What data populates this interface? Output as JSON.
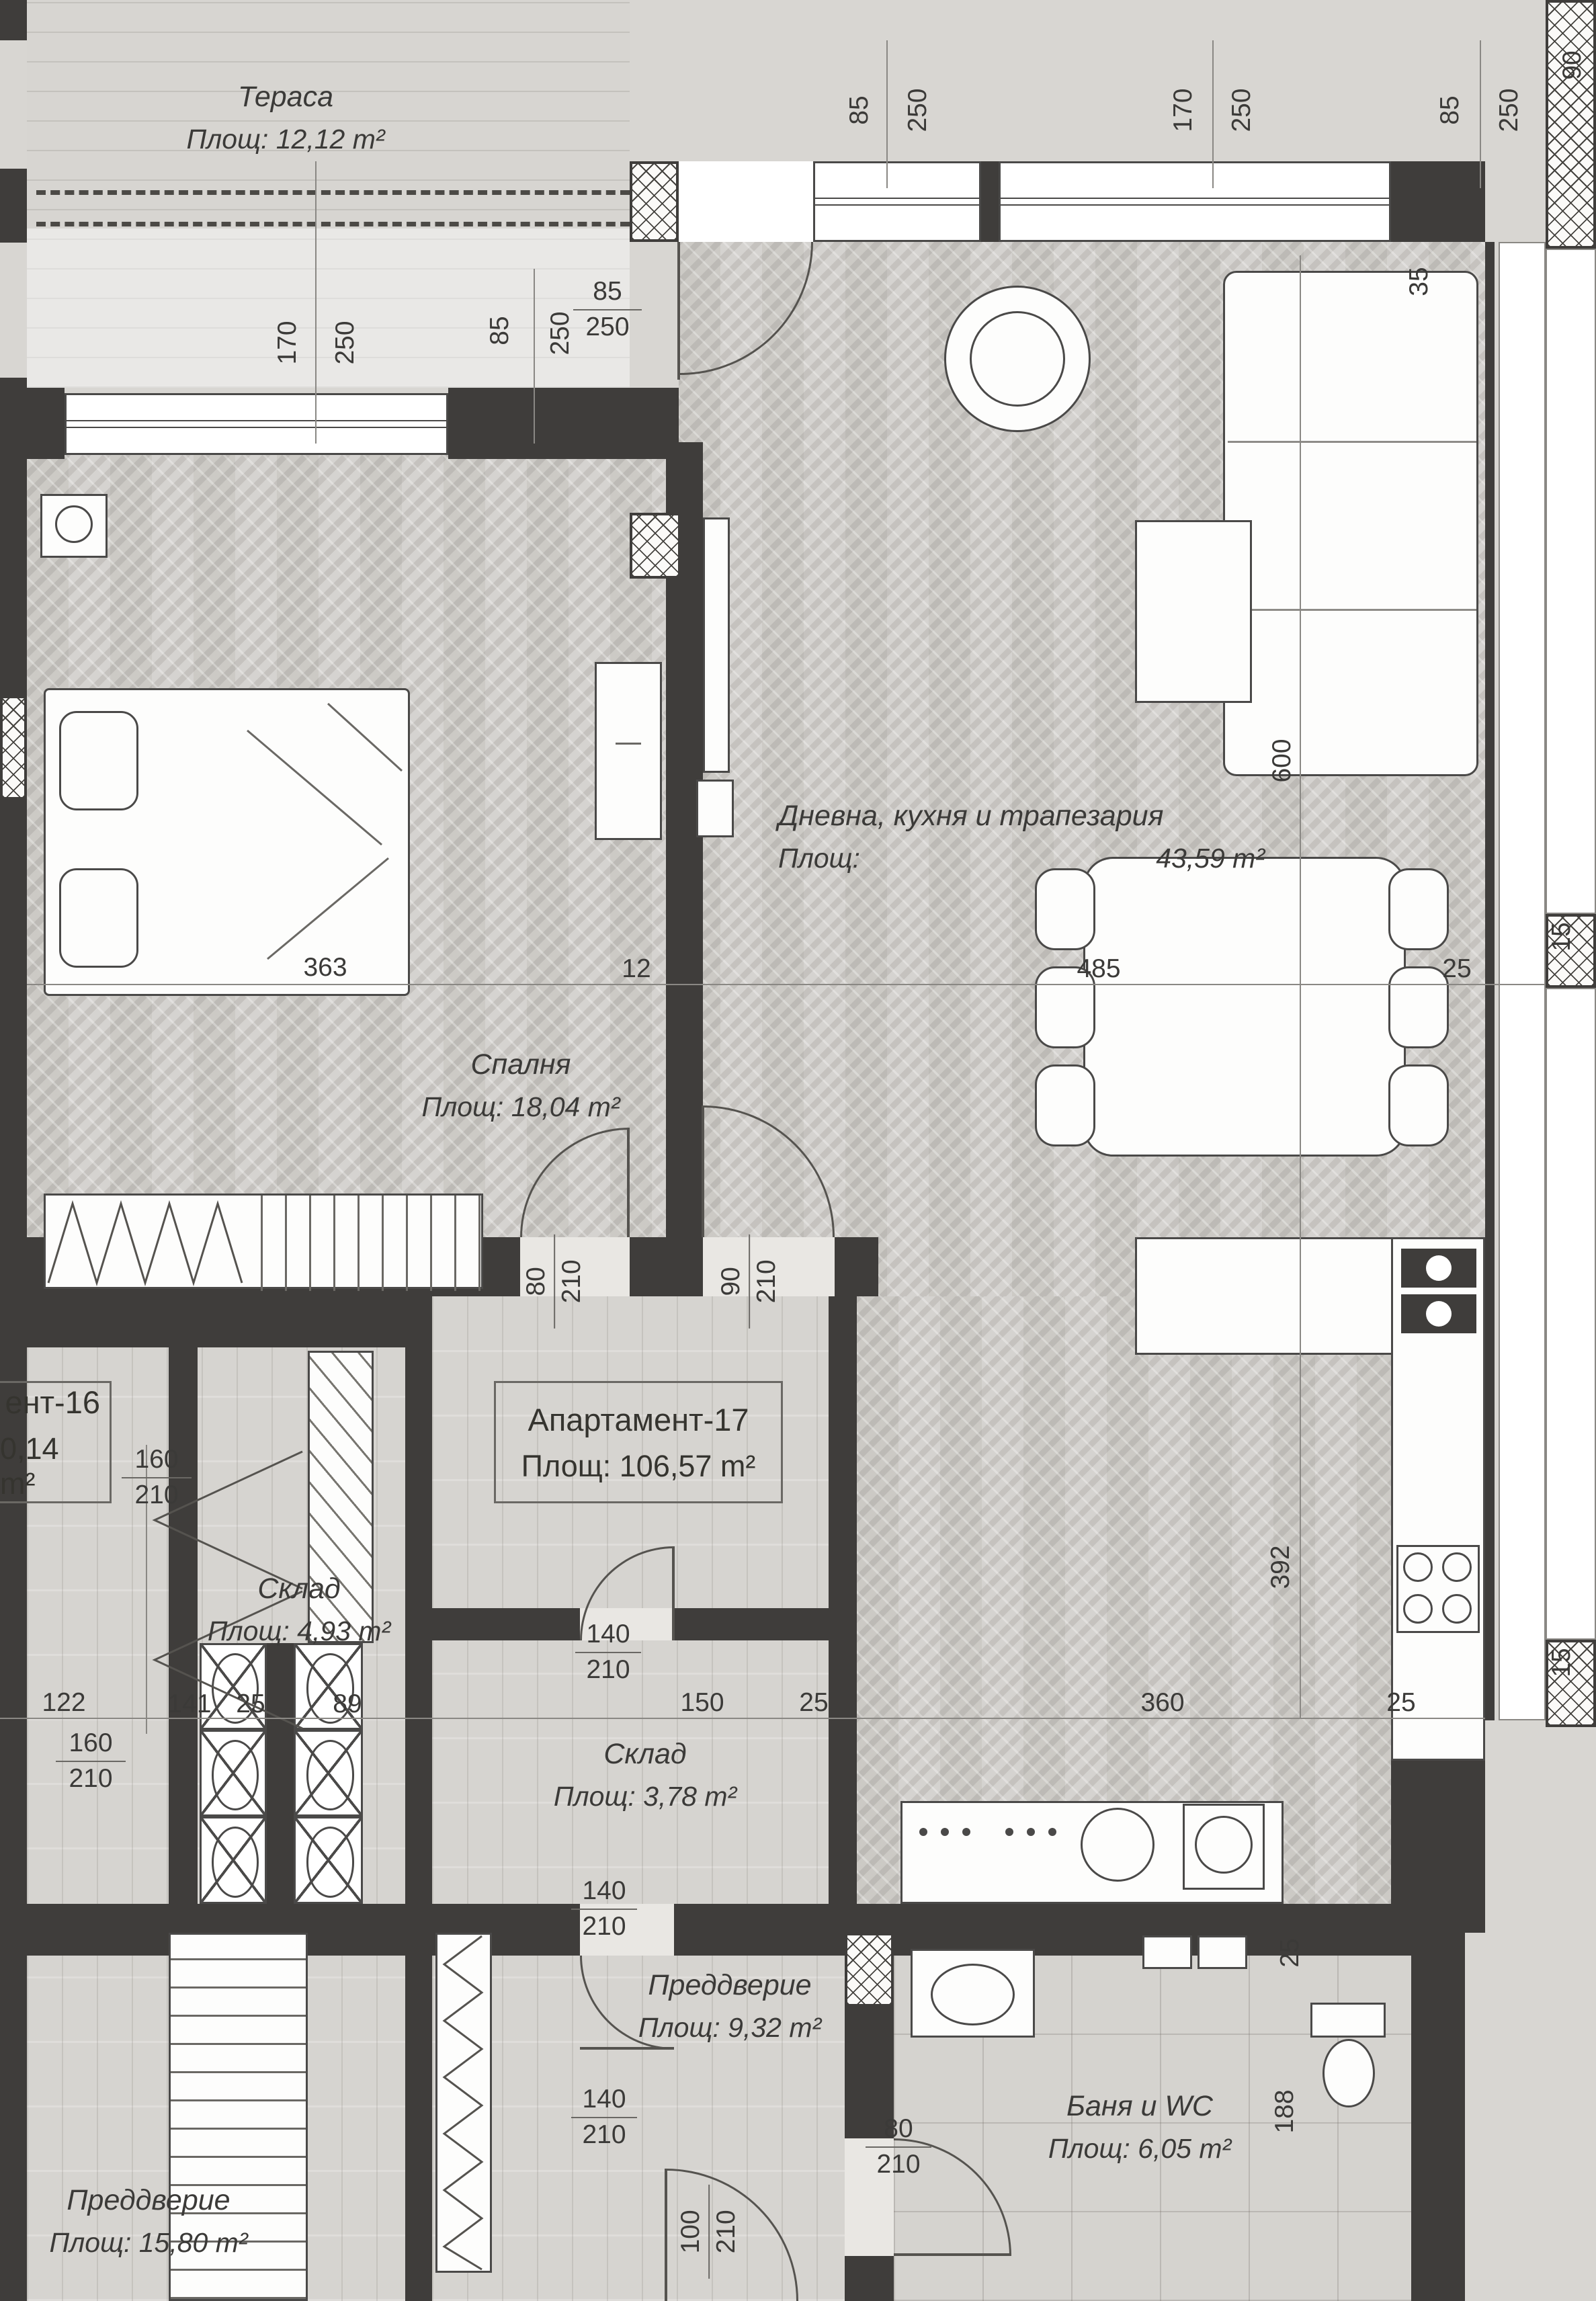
{
  "rooms": {
    "terrace": {
      "name": "Тераса",
      "area": "Площ: 12,12 m²"
    },
    "bedroom": {
      "name": "Спалня",
      "area": "Площ: 18,04 m²"
    },
    "living": {
      "name": "Дневна, кухня и трапезария",
      "area_label": "Площ:",
      "area_value": "43,59 m²"
    },
    "apartment17": {
      "name": "Апартамент-17",
      "area": "Площ: 106,57 m²"
    },
    "apartment16": {
      "name": "ент-16",
      "area": "0,14 m²"
    },
    "storage1": {
      "name": "Склад",
      "area": "Площ: 4,93 m²"
    },
    "storage2": {
      "name": "Склад",
      "area": "Площ: 3,78 m²"
    },
    "hallway17": {
      "name": "Преддверие",
      "area": "Площ: 9,32 m²"
    },
    "bathroom": {
      "name": "Баня и WC",
      "area": "Площ: 6,05 m²"
    },
    "hallway16": {
      "name": "Преддверие",
      "area": "Площ: 15,80 m²"
    }
  },
  "door_window_dims": {
    "top_window_1": {
      "a": "85",
      "b": "250"
    },
    "top_window_2": {
      "a": "170",
      "b": "250"
    },
    "top_window_3": {
      "a": "85",
      "b": "250"
    },
    "top_corner": {
      "a": "90"
    },
    "bedroom_window": {
      "a": "170",
      "b": "250"
    },
    "terrace_side_window": {
      "a": "85",
      "b": "250"
    },
    "entry_door": {
      "a": "85",
      "b": "250"
    },
    "bedroom_door": {
      "a": "80",
      "b": "210"
    },
    "living_door": {
      "a": "90",
      "b": "210"
    },
    "apt16_door_a": {
      "a": "160",
      "b": "210"
    },
    "apt16_door_b": {
      "a": "160",
      "b": "210"
    },
    "storage2_door": {
      "a": "140",
      "b": "210"
    },
    "hall17_upper_door": {
      "a": "140",
      "b": "210"
    },
    "hall17_lower_door": {
      "a": "140",
      "b": "210"
    },
    "bath_door": {
      "a": "80",
      "b": "210"
    },
    "main_entry_door": {
      "a": "100",
      "b": "210"
    }
  },
  "linear_dims": {
    "bedroom_width": "363",
    "bedroom_wall": "12",
    "living_width": "485",
    "living_wall": "25",
    "r122": "122",
    "r141": "141",
    "r25a": "25",
    "r89": "89",
    "r150": "150",
    "r25b": "25",
    "r360": "360",
    "r25c": "25",
    "v600": "600",
    "v392": "392",
    "v188": "188",
    "v35": "35",
    "v25": "25",
    "v15a": "15",
    "v15b": "15"
  },
  "colors": {
    "wall": "#3f3d3b",
    "floor": "#d2d0cc",
    "text": "#3b3a38"
  }
}
